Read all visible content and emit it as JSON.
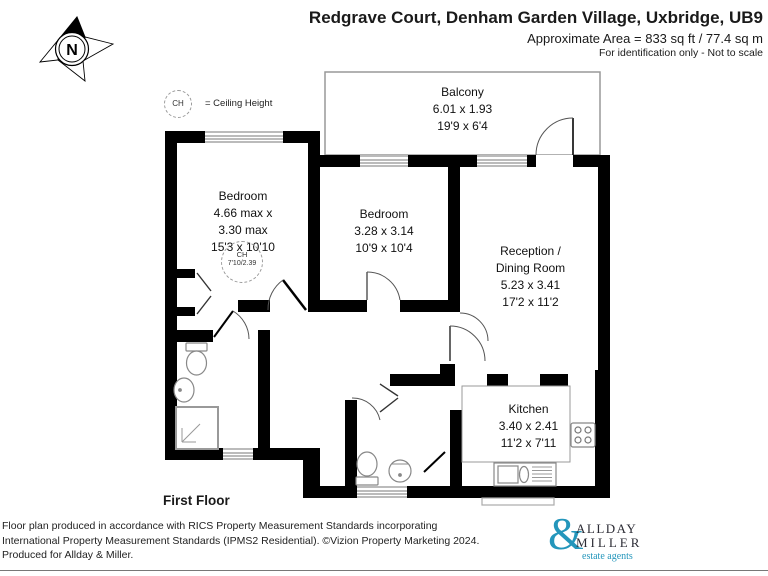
{
  "header": {
    "title": "Redgrave Court, Denham Garden Village, Uxbridge, UB9",
    "area": "Approximate Area = 833 sq ft / 77.4 sq m",
    "note": "For identification only - Not to scale"
  },
  "compass": {
    "label": "N"
  },
  "legend": {
    "ch_abbr": "CH",
    "ch_text": "= Ceiling Height"
  },
  "rooms": {
    "balcony": {
      "name": "Balcony",
      "metric": "6.01 x 1.93",
      "imperial": "19'9 x 6'4"
    },
    "bedroom1": {
      "name": "Bedroom",
      "metric": "4.66 max x",
      "metric2": "3.30 max",
      "imperial": "15'3 x 10'10",
      "ch_abbr": "CH",
      "ch_value": "7'10/2.39"
    },
    "bedroom2": {
      "name": "Bedroom",
      "metric": "3.28 x 3.14",
      "imperial": "10'9 x 10'4"
    },
    "reception": {
      "name1": "Reception /",
      "name2": "Dining Room",
      "metric": "5.23 x 3.41",
      "imperial": "17'2 x 11'2"
    },
    "kitchen": {
      "name": "Kitchen",
      "metric": "3.40 x 2.41",
      "imperial": "11'2 x 7'11"
    }
  },
  "floor_label": "First Floor",
  "footer": {
    "line1": "Floor plan produced in accordance with RICS Property Measurement Standards incorporating",
    "line2": "International Property Measurement Standards (IPMS2 Residential). ©Vizion Property Marketing 2024.",
    "line3": "Produced for Allday & Miller."
  },
  "logo": {
    "ampersand": "&",
    "line1": "ALLDAY",
    "line2": "MILLER",
    "tagline": "estate agents"
  },
  "colors": {
    "accent": "#2496bb",
    "wall": "#000000"
  }
}
